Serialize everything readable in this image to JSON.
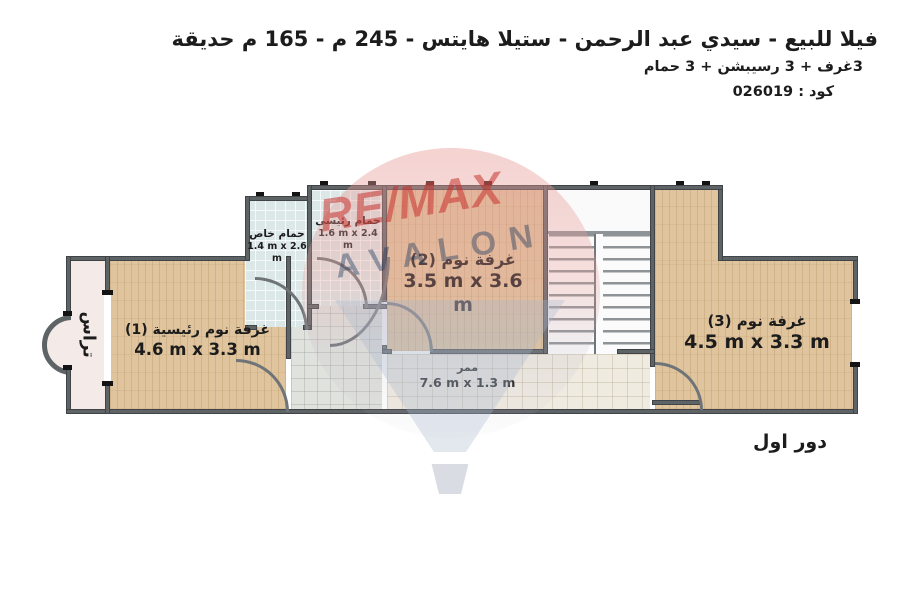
{
  "header": {
    "title": "فيلا للبيع - سيدي عبد الرحمن - ستيلا هايتس - 245 م - 165 م حديقة",
    "subtitle": "3غرف + 3 رسيبشن + 3 حمام",
    "code_label": "كود : 026019"
  },
  "plan": {
    "floor_label": "دور اول",
    "rooms": {
      "terrace": {
        "name": "تراس"
      },
      "master_bedroom": {
        "name": "غرفة نوم رئيسية (1)",
        "dims": "4.6 m x 3.3 m"
      },
      "bedroom_2": {
        "name": "غرفة نوم (2)",
        "dims": "3.5 m x 3.6 m"
      },
      "bedroom_3": {
        "name": "غرفة نوم (3)",
        "dims": "4.5 m x 3.3 m"
      },
      "private_bathroom": {
        "name": "حمام خاص",
        "dims": "1.4 m x 2.6 m"
      },
      "master_bathroom": {
        "name": "حمام رئيسى",
        "dims": "1.6 m x 2.4 m"
      },
      "corridor": {
        "name": "ممر",
        "dims": "7.6 m x 1.3 m"
      }
    }
  },
  "watermark": {
    "brand": "RE/MAX",
    "sub_brand": "AVALON"
  },
  "colors": {
    "wood_floor": "#e0c49d",
    "bath_tile": "#dce8e7",
    "corridor_tile": "#f0ebe1",
    "hall_tile": "#e0e2dd",
    "terrace_floor": "#f4ebe8",
    "wall": "#5e6366",
    "watermark_red": "#c52d28",
    "watermark_navy": "#203a5e",
    "watermark_pink": "#e79d98",
    "text": "#1c1c1c"
  }
}
